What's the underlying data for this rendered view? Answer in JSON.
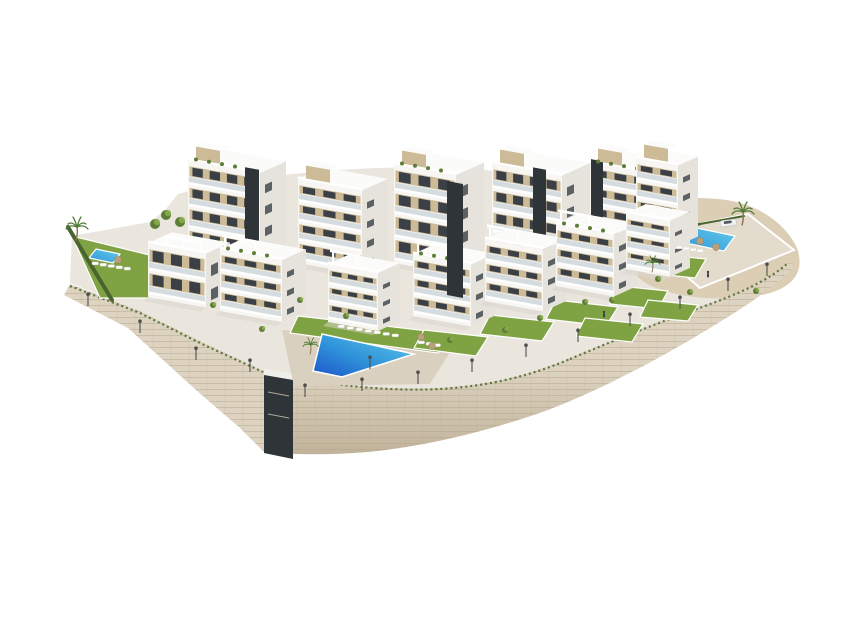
{
  "scene": {
    "title": "Aerial 3D architectural rendering of a modern white apartment complex with swimming pools, landscaped gardens, palm trees and a curved stone retaining wall on a white background",
    "elements_visible": [
      "apartment buildings",
      "communal swimming pool",
      "garden pool",
      "private pool",
      "private lawned gardens",
      "stone retaining wall",
      "elevator tower",
      "palm trees",
      "hedges",
      "street lamps",
      "sun loungers",
      "parasols",
      "parked car",
      "pedestrians",
      "sand terrain"
    ],
    "paths": {
      "plateau": "M70,283 L140,311 202,342 264,371 L296,377 C350,387 400,390 440,388 C490,385 530,375 570,358 C615,339 660,321 702,306 C738,293 768,280 788,262 L794,251 C782,233 757,215 729,208 C703,202 672,202 648,206 L620,212 C600,196 560,180 510,173 C460,166 400,166 340,170 C280,174 220,182 178,194 L165,210 150,222 72,236 Z",
      "sand": "M622,212 C640,200 680,196 718,199 C755,202 785,222 797,248 C804,268 797,285 770,293 C735,302 688,300 656,288 C634,279 625,265 628,250 Z",
      "wall_left": "M70,284 L140,311 202,342 264,371 L264,452 L240,428 196,390 128,328 64,295 Z",
      "wall_crescent": "M264,371 L296,377 C350,387 400,390 440,388 C490,385 530,375 570,358 C615,339 660,321 702,306 C738,293 768,280 790,261 L793,267 C775,288 740,310 700,334 C655,361 600,390 548,410 C495,429 430,446 368,452 C330,455 296,455 264,452 Z",
      "tower": "M264,371 L293,376 L293,459 L264,453 Z",
      "tower_cap": "M264,369 L293,374 L293,380 L264,375 Z",
      "tuft1": "M70,286 L140,313 202,344 263,372",
      "tuft2": "M296,378 C350,388 400,391 440,389 C490,386 530,376 570,359",
      "tuft3": "M570,359 C615,340 660,322 702,307 C738,294 768,281 788,263"
    },
    "decks": [
      {
        "name": "communal-pool-deck",
        "cls": "deck",
        "d": "M282,330 L452,349 L430,384 L294,386 Z"
      },
      {
        "name": "garden-pool-deck",
        "cls": "deck2",
        "d": "M640,236 L748,214 L794,250 L700,288 Z"
      },
      {
        "name": "small-pool-deck",
        "cls": "deck2",
        "d": "M84,246 L130,255 L152,272 L100,273 Z"
      }
    ],
    "lawns": [
      {
        "name": "left-garden-lawn",
        "pts": [
          [
            72,
            236
          ],
          [
            170,
            260
          ],
          [
            205,
            298
          ],
          [
            100,
            298
          ]
        ]
      },
      {
        "name": "pool-lawn",
        "pts": [
          [
            298,
            316
          ],
          [
            454,
            334
          ],
          [
            438,
            353
          ],
          [
            290,
            333
          ]
        ]
      },
      {
        "name": "terrace-lawn",
        "pts": [
          [
            424,
            330
          ],
          [
            488,
            337
          ],
          [
            476,
            356
          ],
          [
            414,
            348
          ]
        ]
      },
      {
        "name": "terrace-lawn",
        "pts": [
          [
            490,
            315
          ],
          [
            554,
            322
          ],
          [
            542,
            341
          ],
          [
            480,
            334
          ]
        ]
      },
      {
        "name": "terrace-lawn",
        "pts": [
          [
            556,
            300
          ],
          [
            618,
            307
          ],
          [
            606,
            326
          ],
          [
            546,
            319
          ]
        ]
      },
      {
        "name": "terrace-lawn",
        "pts": [
          [
            618,
            286
          ],
          [
            668,
            291
          ],
          [
            658,
            309
          ],
          [
            610,
            304
          ]
        ]
      },
      {
        "name": "terrace-lawn",
        "pts": [
          [
            585,
            318
          ],
          [
            643,
            324
          ],
          [
            632,
            342
          ],
          [
            576,
            336
          ]
        ]
      },
      {
        "name": "terrace-lawn",
        "pts": [
          [
            648,
            300
          ],
          [
            698,
            305
          ],
          [
            688,
            321
          ],
          [
            640,
            317
          ]
        ]
      },
      {
        "name": "garden-pool-lawn",
        "pts": [
          [
            658,
            254
          ],
          [
            706,
            259
          ],
          [
            695,
            278
          ],
          [
            647,
            273
          ]
        ]
      }
    ],
    "pools": {
      "main": {
        "name": "communal-pool",
        "pts": [
          [
            322,
            334
          ],
          [
            414,
            354
          ],
          [
            342,
            377
          ],
          [
            313,
            371
          ]
        ]
      },
      "small": [
        {
          "name": "left-garden-pool",
          "pts": [
            [
              96,
              249
            ],
            [
              120,
              254
            ],
            [
              113,
              263
            ],
            [
              89,
              258
            ]
          ]
        },
        {
          "name": "right-garden-pool",
          "pts": [
            [
              692,
              227
            ],
            [
              735,
              236
            ],
            [
              724,
              251
            ],
            [
              681,
              242
            ]
          ]
        }
      ]
    },
    "hedges": [
      {
        "x1": 68,
        "y1": 227,
        "x2": 112,
        "y2": 300,
        "w": 4
      },
      {
        "x1": 645,
        "y1": 236,
        "x2": 700,
        "y2": 224,
        "w": 2.5
      },
      {
        "x1": 700,
        "y1": 224,
        "x2": 744,
        "y2": 216,
        "w": 2
      }
    ],
    "buildings": {
      "back": [
        {
          "x": 188,
          "y": 252,
          "w": 72,
          "d": 26,
          "h": 92,
          "f": 4,
          "shaft": {
            "o": 57,
            "w": 14,
            "drop": 8
          },
          "bulk": true,
          "plants": true
        },
        {
          "x": 298,
          "y": 263,
          "w": 64,
          "d": 26,
          "h": 84,
          "f": 4,
          "bulk": true
        },
        {
          "x": 394,
          "y": 263,
          "w": 62,
          "d": 28,
          "h": 99,
          "f": 4,
          "bulk": true,
          "plants": true
        },
        {
          "x": 492,
          "y": 256,
          "w": 70,
          "d": 28,
          "h": 93,
          "f": 4,
          "shaft": {
            "o": 41,
            "w": 13,
            "drop": 30
          },
          "bulk": true
        },
        {
          "x": 590,
          "y": 246,
          "w": 62,
          "d": 26,
          "h": 84,
          "f": 4,
          "shaft": {
            "o": 1,
            "w": 12,
            "drop": 4
          },
          "bulk": true,
          "plants": true
        },
        {
          "x": 636,
          "y": 238,
          "w": 42,
          "d": 20,
          "h": 80,
          "f": 4,
          "bulk": true
        }
      ],
      "front": [
        {
          "x": 148,
          "y": 297,
          "w": 58,
          "d": 24,
          "h": 54,
          "f": 2,
          "pergola": true
        },
        {
          "x": 220,
          "y": 311,
          "w": 62,
          "d": 24,
          "h": 62,
          "f": 3,
          "frame": true,
          "plants": true
        },
        {
          "x": 328,
          "y": 322,
          "w": 50,
          "d": 22,
          "h": 58,
          "f": 3,
          "frame": true
        },
        {
          "x": 413,
          "y": 316,
          "w": 58,
          "d": 24,
          "h": 62,
          "f": 3,
          "frame": true,
          "plants": true
        },
        {
          "x": 485,
          "y": 301,
          "w": 58,
          "d": 24,
          "h": 62,
          "f": 3,
          "frame": true
        },
        {
          "x": 556,
          "y": 286,
          "w": 58,
          "d": 24,
          "h": 62,
          "f": 3,
          "frame": true,
          "plants": true
        },
        {
          "x": 626,
          "y": 269,
          "w": 44,
          "d": 20,
          "h": 56,
          "f": 3
        }
      ],
      "standalone_shaft": {
        "x1": 447,
        "y1": 295,
        "x2": 463,
        "y2": 298,
        "top": 181
      }
    },
    "lamps": [
      [
        88,
        306
      ],
      [
        140,
        333
      ],
      [
        196,
        360
      ],
      [
        250,
        372
      ],
      [
        305,
        397
      ],
      [
        362,
        391
      ],
      [
        418,
        384
      ],
      [
        472,
        372
      ],
      [
        526,
        357
      ],
      [
        578,
        342
      ],
      [
        630,
        326
      ],
      [
        680,
        309
      ],
      [
        728,
        291
      ],
      [
        767,
        276
      ],
      [
        370,
        369
      ]
    ],
    "shrubs": [
      [
        213,
        305
      ],
      [
        262,
        329
      ],
      [
        300,
        300
      ],
      [
        346,
        316
      ],
      [
        658,
        279
      ],
      [
        690,
        292
      ],
      [
        612,
        300
      ],
      [
        756,
        291
      ],
      [
        540,
        318
      ],
      [
        585,
        302
      ],
      [
        505,
        330
      ],
      [
        450,
        340
      ]
    ],
    "trees": [
      [
        166,
        215
      ],
      [
        180,
        222
      ],
      [
        155,
        224
      ]
    ],
    "palms": [
      {
        "x": 76,
        "y": 240,
        "s": 1.0
      },
      {
        "x": 742,
        "y": 225,
        "s": 1.0
      },
      {
        "x": 652,
        "y": 272,
        "s": 0.7
      },
      {
        "x": 310,
        "y": 354,
        "s": 0.7
      }
    ],
    "umbrellas": [
      [
        421,
        337
      ],
      [
        432,
        346
      ],
      [
        700,
        241
      ],
      [
        716,
        247
      ],
      [
        118,
        260
      ]
    ],
    "lounger_rows": [
      {
        "x": 338,
        "y": 325,
        "n": 7,
        "dx": 9,
        "dy": 1.5
      },
      {
        "x": 92,
        "y": 262,
        "n": 5,
        "dx": 8,
        "dy": 1.3
      },
      {
        "x": 676,
        "y": 246,
        "n": 4,
        "dx": 7,
        "dy": 1.1
      },
      {
        "x": 418,
        "y": 341,
        "n": 3,
        "dx": 8,
        "dy": 1.4
      }
    ],
    "people": [
      [
        604,
        316
      ],
      [
        708,
        276
      ]
    ],
    "car": {
      "x": 720,
      "y": 221
    }
  },
  "colors": {
    "bg": "#ffffff",
    "paving": "#eae6de",
    "deck": "#d9d0bf",
    "deck-2": "#e3dccd",
    "wall-light": "#ddd3c0",
    "wall-mid": "#cdc1aa",
    "wall-dark": "#bfb198",
    "wall-line": "#b3a488",
    "sand": "#dbceb5",
    "sand-light": "#e7dcc7",
    "lawn": "#7fa342",
    "lawn-light": "#93b452",
    "hedge": "#4a652e",
    "shrub": "#5d7d37",
    "facade": "#f7f6f3",
    "facade-shade": "#e6e3dd",
    "roof": "#fbfbfa",
    "slab": "#ffffff",
    "rail": "#ccd6d9",
    "panel": "#cdbb98",
    "window": "#3a4046",
    "accent": "#2e3437",
    "pool-deep": "#1d55c9",
    "pool-mid": "#2f93da",
    "pool-light": "#64cde8",
    "trunk": "#8a7354",
    "frond": "#4e7c33",
    "lamp": "#4f4f4f",
    "car-body": "#f2f2f2",
    "car-glass": "#50575c",
    "shadow": "#d9d5cc",
    "person": "#3c4248",
    "umbrella": "#b9a07a"
  }
}
